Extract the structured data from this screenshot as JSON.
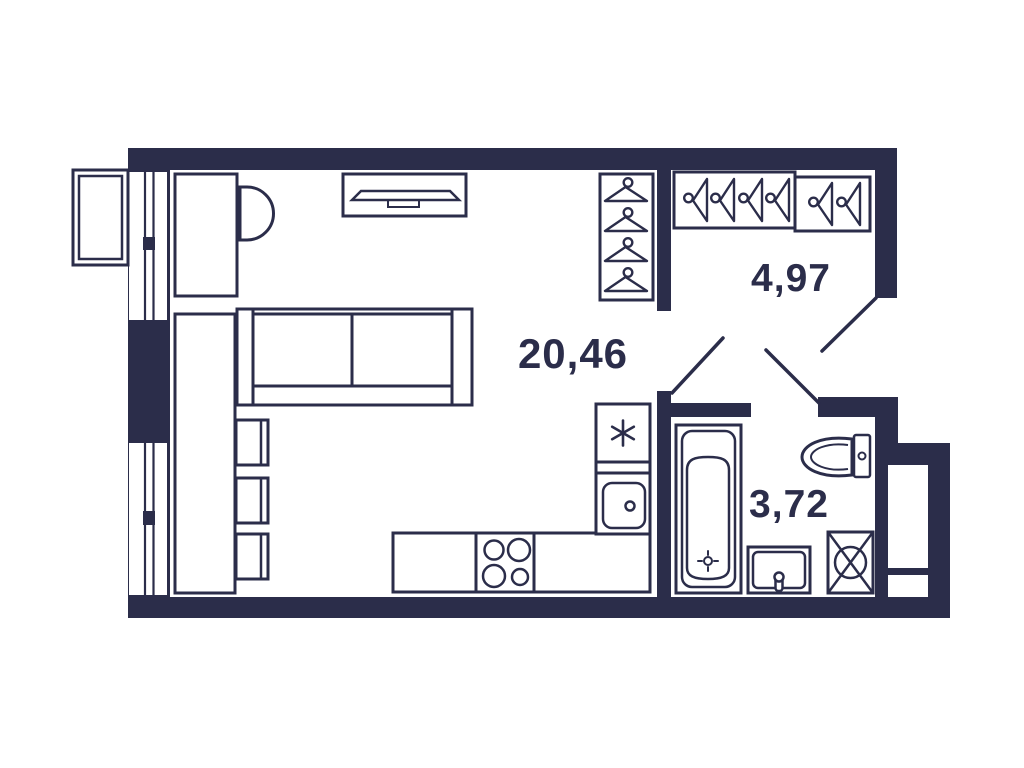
{
  "plan": {
    "type": "studio-apartment-floor-plan",
    "colors": {
      "ink": "#2b2d4a",
      "background": "#ffffff"
    },
    "rooms": [
      {
        "id": "living-kitchen",
        "area": "20,46"
      },
      {
        "id": "hallway",
        "area": "4,97"
      },
      {
        "id": "bathroom",
        "area": "3,72"
      }
    ],
    "furniture": {
      "living_kitchen": [
        "desk",
        "desk-chair",
        "tv-stand",
        "wardrobe-with-hangers",
        "sofa",
        "table",
        "chair",
        "chair",
        "chair",
        "refrigerator",
        "kitchen-sink-counter",
        "stove-counter"
      ],
      "hallway": [
        "closet-with-hangers-large",
        "closet-with-hangers-small"
      ],
      "bathroom": [
        "bathtub",
        "toilet",
        "vanity-sink",
        "washing-machine"
      ]
    },
    "features": [
      "window-upper",
      "window-lower",
      "ac-basket",
      "entrance-door",
      "room-door",
      "bathroom-door",
      "ventilation-shaft"
    ]
  }
}
